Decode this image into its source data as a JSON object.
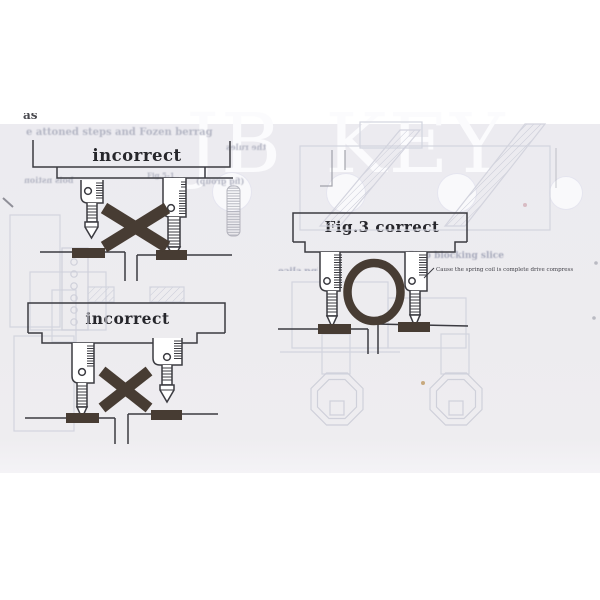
{
  "watermark": {
    "text": "JB KEY"
  },
  "top_margin": {
    "clipped_text": "as described."
  },
  "figures": {
    "top_incorrect": {
      "label": "incorrect"
    },
    "bottom_incorrect": {
      "label": "incorrect"
    },
    "correct": {
      "label": "Fig.3 correct",
      "caption": "Cause the spring coil is complete drive compress"
    }
  },
  "ghost_text": {
    "line_top": "e attoned steps and Fozen berrag",
    "side_note": "the rules",
    "left_note": "bois nstion",
    "fig_ref": "Fig.5-1",
    "fig_group": "(fig group)",
    "stop_blocking": "Stop blocking slice",
    "stop_blocking_mirrored": "Stop blocking slice"
  },
  "colors": {
    "paper": "#edecf0",
    "ink": "#3b3b41",
    "marker": "#473c33",
    "ghost": "#c2c4d0",
    "watermark": "#fbfbfd"
  }
}
